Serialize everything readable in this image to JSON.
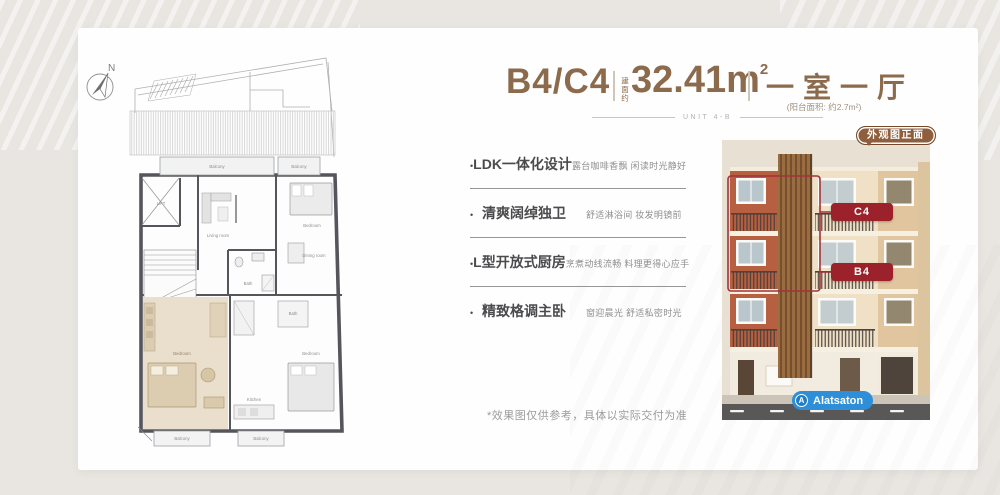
{
  "header": {
    "unit_code": "B4/C4",
    "area_label_vertical": "建面约",
    "area_value": "32.41m",
    "area_superscript": "2",
    "layout_name": "一室一厅",
    "balcony_area_note": "(阳台面积: 约2.7m²)",
    "unit_line_text": "UNIT 4-B"
  },
  "feature_bullet": "•",
  "features": [
    {
      "title": "LDK一体化设计",
      "desc": "露台咖啡香飘 闲读时光静好"
    },
    {
      "title": "清爽阔绰独卫",
      "desc": "舒适淋浴间 妆发明镜前"
    },
    {
      "title": "L型开放式厨房",
      "desc": "烹煮动线流畅 料理更得心应手"
    },
    {
      "title": "精致格调主卧",
      "desc": "窗迎晨光 舒适私密时光"
    }
  ],
  "disclaimer": "*效果图仅供参考，具体以实际交付为准",
  "exterior": {
    "tag_label": "外观图正面",
    "unit_badges": [
      "C4",
      "B4"
    ],
    "brand_name": "Alatsaton",
    "brand_initial": "A"
  },
  "floor_plan": {
    "compass_label": "N",
    "labels": {
      "lift": "LIFT",
      "balcony": "Balcony",
      "living_room": "Living room",
      "bedroom": "Bedroom",
      "dining_room": "Dining room",
      "kitchen": "Kitchen",
      "bath": "Bath"
    }
  },
  "colors": {
    "accent_brown": "#8c6a4c",
    "badge_red": "#9b222b",
    "tag_brown": "#8f5e3d",
    "brand_blue": "#2e8fd8",
    "highlight_beige": "#eadfcd",
    "outline_red": "#a23238"
  }
}
